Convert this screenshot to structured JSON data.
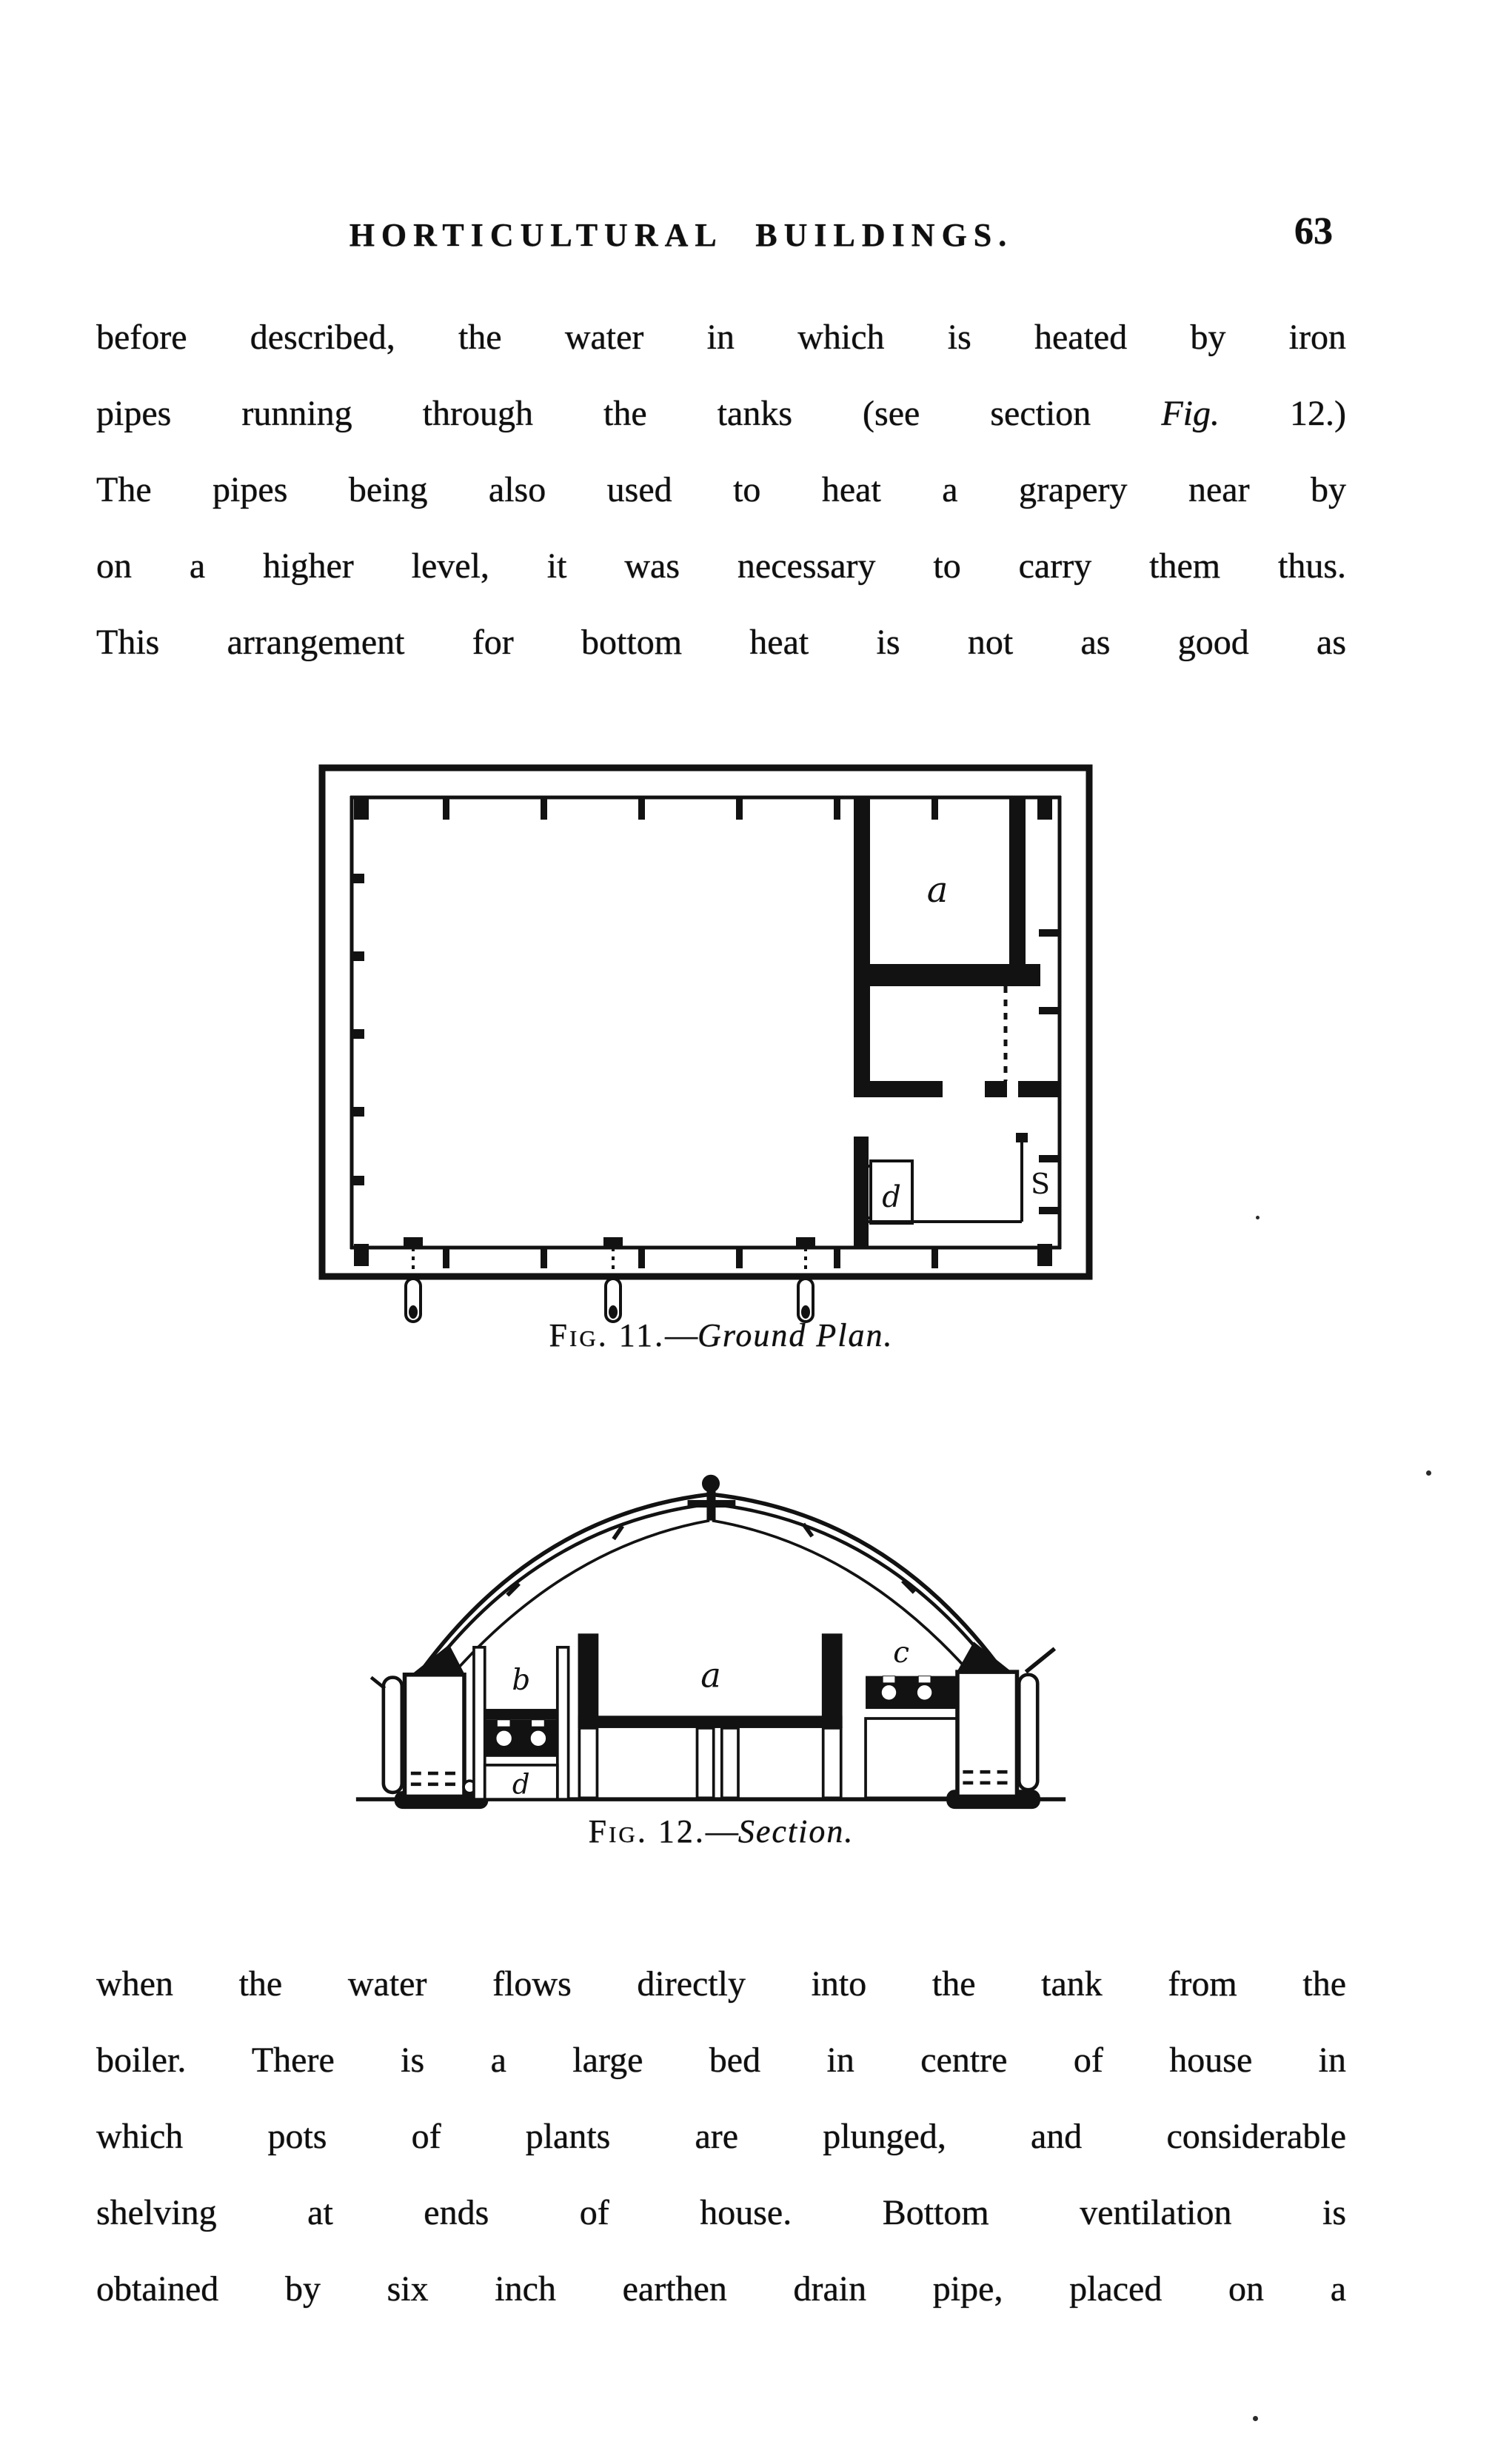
{
  "page": {
    "header": "HORTICULTURAL BUILDINGS.",
    "number": "63"
  },
  "paragraph1": {
    "line1": "before described, the water in which is heated by iron",
    "line2_pre": "pipes running through the tanks (see section",
    "line2_italic": "Fig.",
    "line2_post": "12.)",
    "line3": "The pipes being also used to heat a grapery near by",
    "line4": "on a higher level, it was necessary to carry them thus.",
    "line5": "This arrangement for bottom heat is not as good as"
  },
  "fig11": {
    "caption_label": "Fig. 11.",
    "caption_sep": "—",
    "caption_title": "Ground Plan.",
    "labels": {
      "room": "a",
      "flue": "d",
      "shelf": "S"
    }
  },
  "fig12": {
    "caption_label": "Fig. 12.",
    "caption_sep": "—",
    "caption_title": "Section.",
    "labels": {
      "bed": "a",
      "left_bench": "b",
      "right_bench": "c",
      "flue": "d"
    }
  },
  "paragraph2": {
    "line1": "when the water flows directly into the tank from the",
    "line2": "boiler.  There is a large bed in centre of house in",
    "line3": "which pots of plants are plunged, and considerable",
    "line4": "shelving at ends of house.  Bottom ventilation is",
    "line5": "obtained by six inch earthen drain pipe, placed on a"
  }
}
